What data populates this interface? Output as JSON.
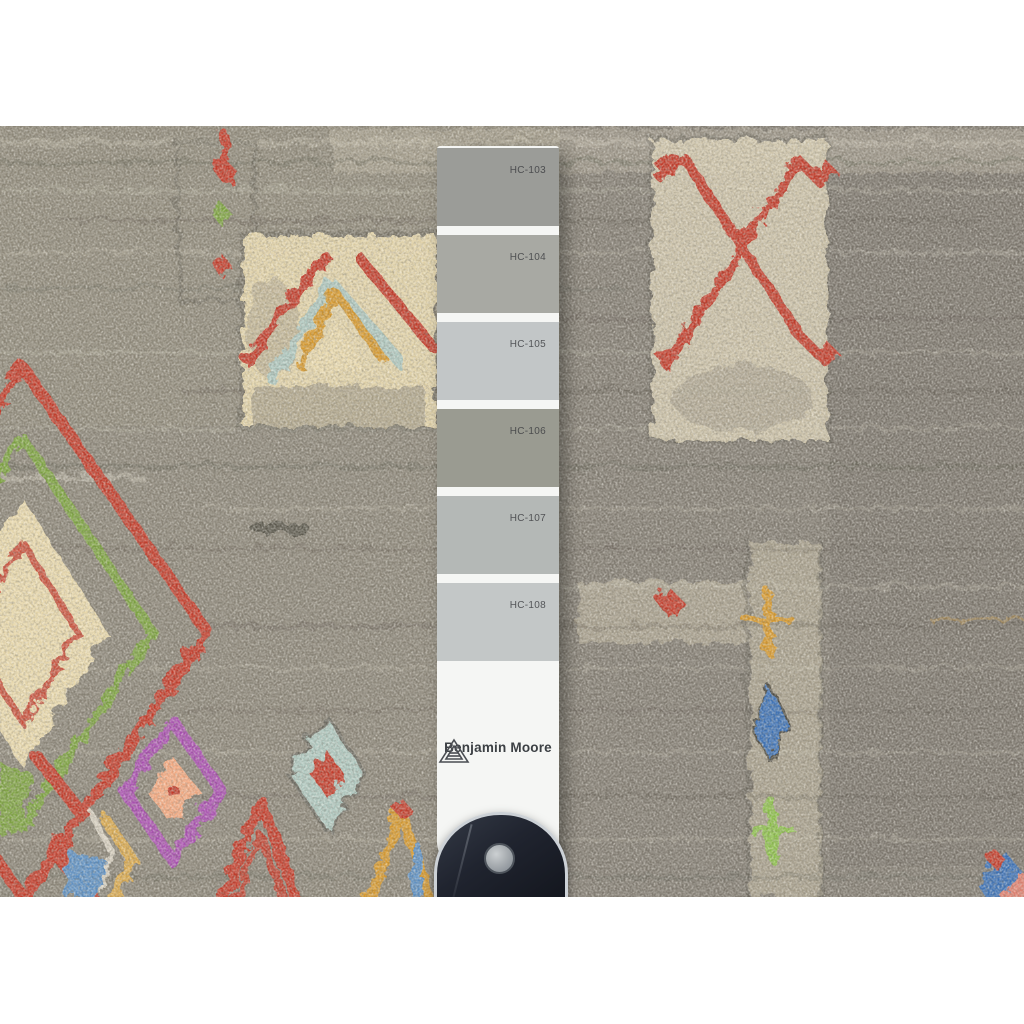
{
  "image": {
    "subject": "Gray hand-knotted wool rug with multicolor tribal motifs, photographed with a Benjamin Moore gray paint sample strip laid on top, held by a dark clip handle"
  },
  "palette": {
    "red": "#c23a2a",
    "green": "#7ca23f",
    "gold": "#d5982f",
    "cream": "#e8d8ac",
    "teal": "#aec7bf",
    "purple": "#a84fb0",
    "peach": "#f4a981",
    "blue": "#3a6fb5",
    "skyblue": "#5b8fc3",
    "rugbase": "#8a8477",
    "rugdark": "#56524a",
    "ruglight": "#d6d0bf"
  },
  "strip": {
    "brand": "Benjamin Moore",
    "logo_icon": "benjamin-moore-triangle-icon",
    "paper_color": "#f5f6f4",
    "swatches": [
      {
        "code": "HC-103",
        "color": "#9b9c98"
      },
      {
        "code": "HC-104",
        "color": "#a8a9a3"
      },
      {
        "code": "HC-105",
        "color": "#c2c6c7"
      },
      {
        "code": "HC-106",
        "color": "#9a9b91"
      },
      {
        "code": "HC-107",
        "color": "#b4b8b6"
      },
      {
        "code": "HC-108",
        "color": "#c3c7c7"
      }
    ]
  },
  "handle": {
    "body_color": "#1d212b",
    "rivet_color": "#9aa0a6"
  }
}
